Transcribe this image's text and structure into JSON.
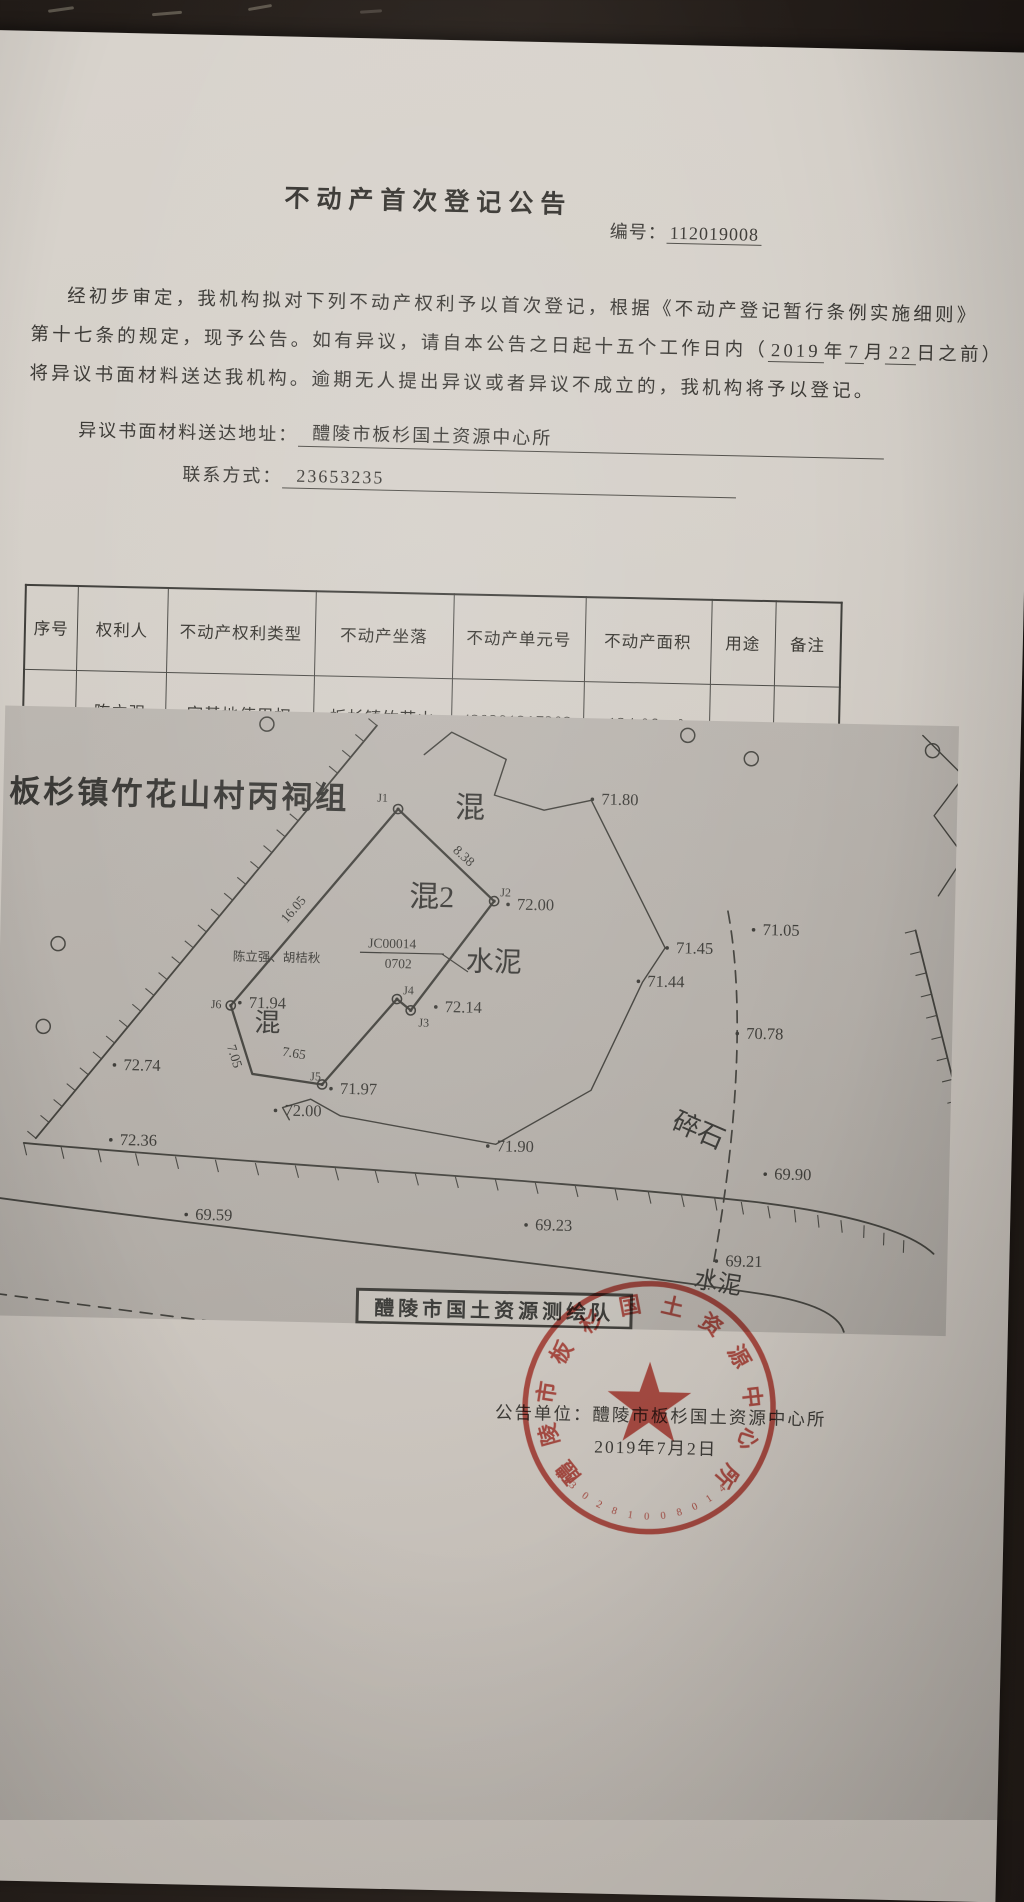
{
  "doc": {
    "title": "不动产首次登记公告",
    "no_label": "编号：",
    "no_value": "112019008",
    "para": {
      "l1": "经初步审定，我机构拟对下列不动产权利予以首次登记，根据《不动产登记暂行条例实施细则》",
      "l2_pre": "第十七条的规定，现予公告。如有异议，请自本公告之日起十五个工作日内（",
      "l2_year": "2019",
      "l2_s1": "年",
      "l2_month": "7",
      "l2_s2": "月",
      "l2_day": "22",
      "l2_post": "日之前）",
      "l3": "将异议书面材料送达我机构。逾期无人提出异议或者异议不成立的，我机构将予以登记。"
    },
    "address_label": "异议书面材料送达地址：",
    "address_value": "醴陵市板杉国土资源中心所",
    "contact_label": "联系方式：",
    "contact_value": "23653235"
  },
  "table": {
    "headers": [
      "序号",
      "权利人",
      "不动产权利类型",
      "不动产坐落",
      "不动产单元号",
      "不动产面积",
      "用途",
      "备注"
    ],
    "rows": [
      {
        "seq": "1",
        "holder": [
          "陈立强",
          "胡桔秋"
        ],
        "right_type": [
          "宅基地使用权",
          "/房屋所有权"
        ],
        "location": [
          "板杉镇竹花山",
          "村丙祠组"
        ],
        "unit": [
          "430281217203",
          "JC00014"
        ],
        "area": [
          "124.06 m²",
          "214.28 m²"
        ],
        "usage": "住宅",
        "remark": ""
      }
    ]
  },
  "map": {
    "title": "板杉镇竹花山村丙祠组",
    "owner_label": "陈立强、胡桔秋",
    "code_top": "JC00014",
    "code_bottom": "0702",
    "surveyor_box": "醴陵市国土资源测绘队",
    "elevations": [
      {
        "x": 598,
        "y": 86,
        "v": "71.80"
      },
      {
        "x": 516,
        "y": 193,
        "v": "72.00"
      },
      {
        "x": 676,
        "y": 233,
        "v": "71.45"
      },
      {
        "x": 648,
        "y": 267,
        "v": "71.44"
      },
      {
        "x": 762,
        "y": 213,
        "v": "71.05"
      },
      {
        "x": 748,
        "y": 317,
        "v": "70.78"
      },
      {
        "x": 250,
        "y": 297,
        "v": "71.94"
      },
      {
        "x": 446,
        "y": 297,
        "v": "72.14"
      },
      {
        "x": 343,
        "y": 381,
        "v": "71.97"
      },
      {
        "x": 288,
        "y": 404,
        "v": "72.00"
      },
      {
        "x": 126,
        "y": 362,
        "v": "72.74"
      },
      {
        "x": 124,
        "y": 437,
        "v": "72.36"
      },
      {
        "x": 501,
        "y": 435,
        "v": "71.90"
      },
      {
        "x": 201,
        "y": 510,
        "v": "69.59"
      },
      {
        "x": 541,
        "y": 513,
        "v": "69.23"
      },
      {
        "x": 779,
        "y": 457,
        "v": "69.90"
      },
      {
        "x": 732,
        "y": 545,
        "v": "69.21"
      }
    ],
    "jpoints": [
      {
        "x": 395,
        "y": 95,
        "l": "J1",
        "lx": 374,
        "ly": 88
      },
      {
        "x": 493,
        "y": 185,
        "l": "J2",
        "lx": 499,
        "ly": 180
      },
      {
        "x": 412,
        "y": 296,
        "l": "J3",
        "lx": 420,
        "ly": 312
      },
      {
        "x": 398,
        "y": 285,
        "l": "J4",
        "lx": 404,
        "ly": 280
      },
      {
        "x": 325,
        "y": 372,
        "l": "J5",
        "lx": 313,
        "ly": 368
      },
      {
        "x": 232,
        "y": 295,
        "l": "J6",
        "lx": 212,
        "ly": 298
      }
    ],
    "edge_labels": [
      {
        "x": 450,
        "y": 136,
        "v": "8.38",
        "r": 41
      },
      {
        "x": 286,
        "y": 212,
        "v": "16.05",
        "r": -50
      },
      {
        "x": 284,
        "y": 344,
        "v": "7.65",
        "r": 8
      },
      {
        "x": 229,
        "y": 336,
        "v": "7.05",
        "r": 71
      }
    ],
    "area_labels": [
      {
        "x": 452,
        "y": 102,
        "v": "混",
        "s": 30,
        "r": 0
      },
      {
        "x": 408,
        "y": 192,
        "v": "混2",
        "s": 30,
        "r": 0
      },
      {
        "x": 256,
        "y": 320,
        "v": "混",
        "s": 26,
        "r": 0
      },
      {
        "x": 466,
        "y": 255,
        "v": "水泥",
        "s": 28,
        "r": 0
      },
      {
        "x": 674,
        "y": 408,
        "v": "碎石",
        "s": 27,
        "r": 22
      },
      {
        "x": 700,
        "y": 566,
        "v": "水泥",
        "s": 24,
        "r": 8
      }
    ]
  },
  "footer": {
    "unit_label": "公告单位：",
    "unit_value": "醴陵市板杉国土资源中心所",
    "date": "2019年7月2日"
  },
  "seal": {
    "ring_text": "醴陵市板杉国土资源中心所",
    "number": "4302810080145",
    "color": "#c23a30"
  }
}
